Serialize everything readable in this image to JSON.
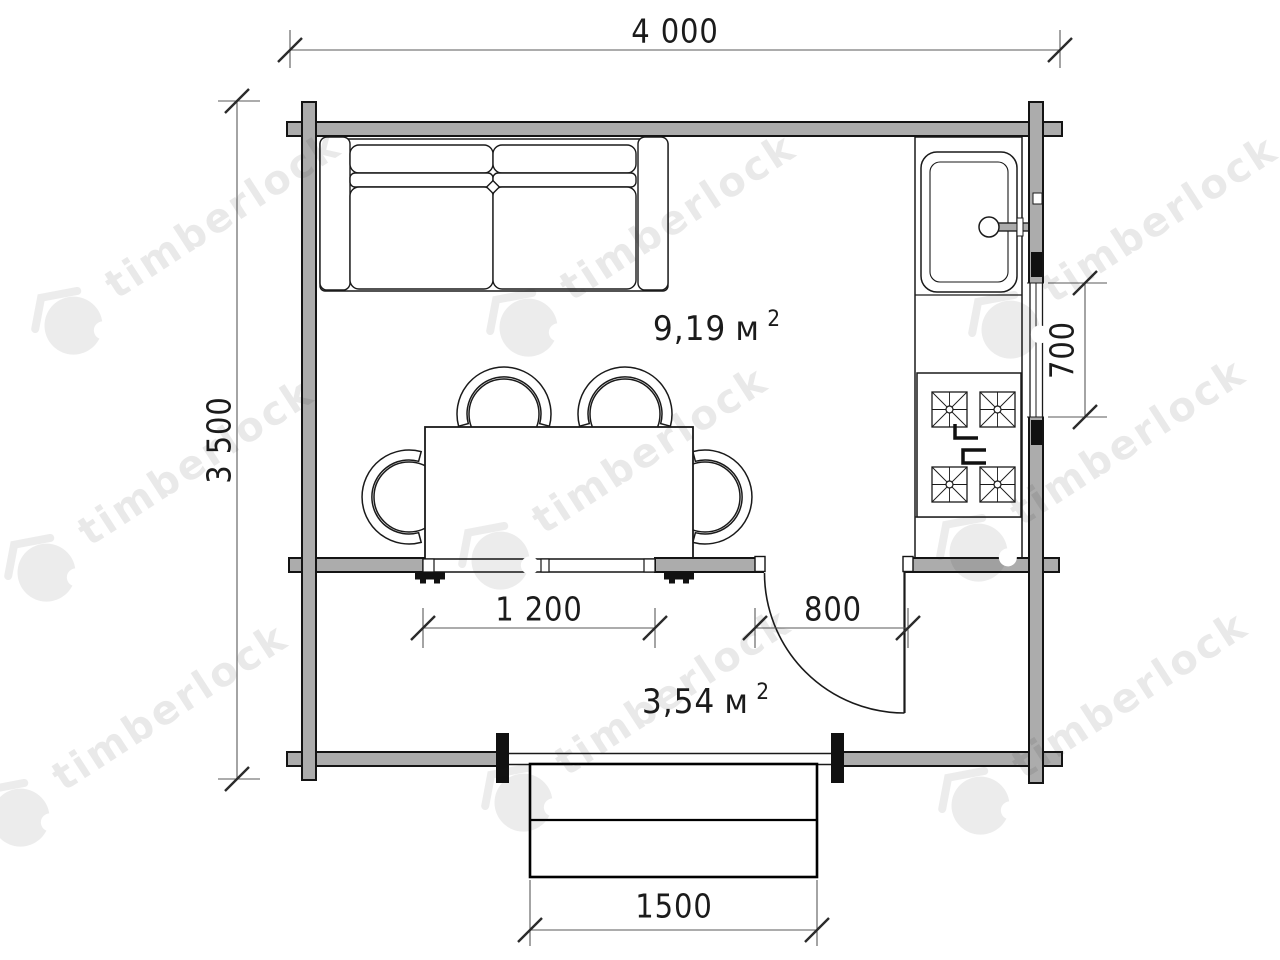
{
  "watermark": {
    "text": "timberlock"
  },
  "plan": {
    "dimensions": {
      "overall_width": "4 000",
      "overall_depth": "3 500",
      "front_window_width": "1 200",
      "door_width": "800",
      "side_window_width": "700",
      "porch_width": "1500"
    },
    "rooms": {
      "main": {
        "area": "9,19",
        "unit": "м",
        "sup": "2"
      },
      "terrace": {
        "area": "3,54",
        "unit": "м",
        "sup": "2"
      }
    }
  }
}
